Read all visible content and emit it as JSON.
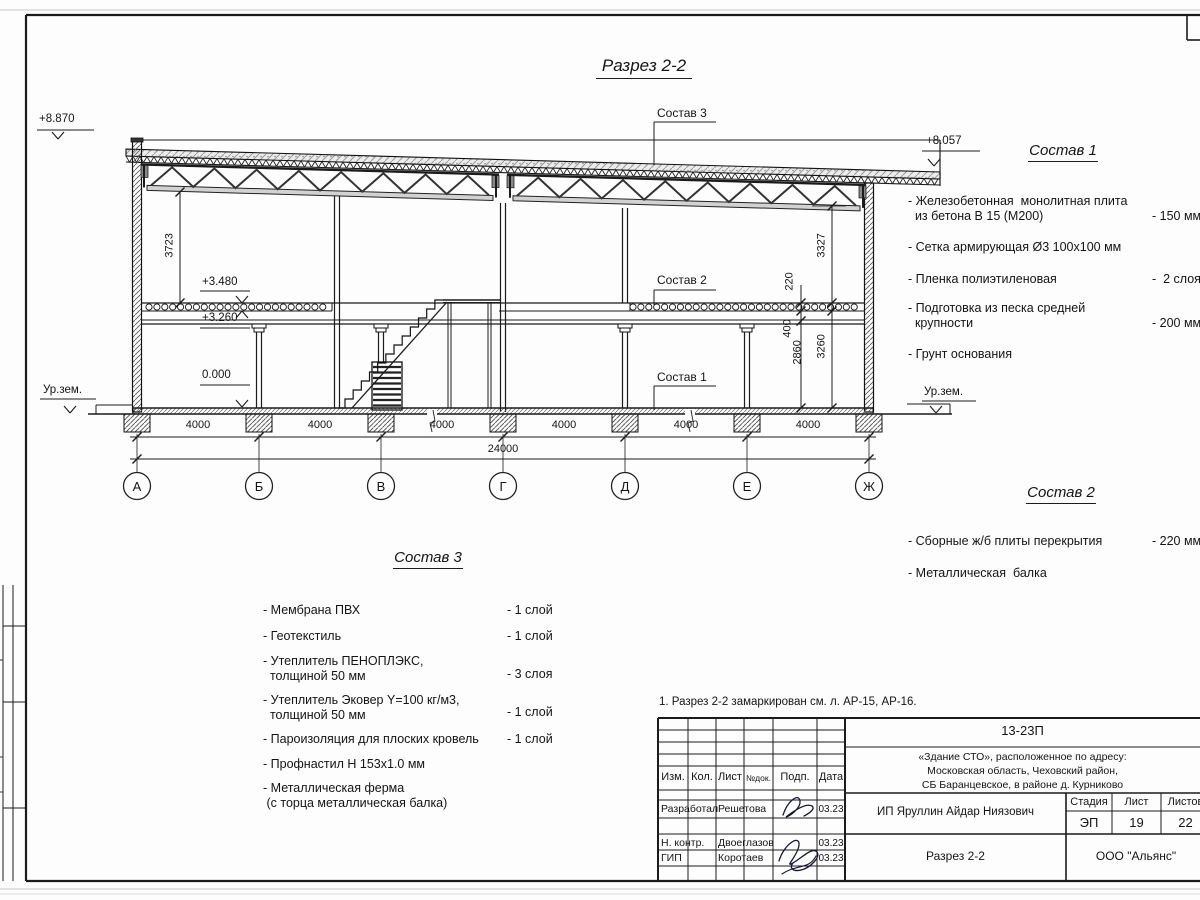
{
  "drawing": {
    "title": "Разрез 2-2",
    "note": "1. Разрез 2-2 замаркирован см. л. АР-15, АР-16."
  },
  "elevations": {
    "roof_left": "+8.870",
    "roof_right": "+8.057",
    "slab_top": "+3.480",
    "slab_bottom": "+3.260",
    "zero": "0.000",
    "ground_left": "Ур.зем.",
    "ground_right": "Ур.зем."
  },
  "dims": {
    "h_left": "3723",
    "h_right": "3327",
    "slab": "220",
    "beam": "400",
    "clear": "2860",
    "storey": "3260",
    "bays": [
      "4000",
      "4000",
      "4000",
      "4000",
      "4000",
      "4000"
    ],
    "total": "24000"
  },
  "axes": [
    "А",
    "Б",
    "В",
    "Г",
    "Д",
    "Е",
    "Ж"
  ],
  "callouts": {
    "c1": "Состав 1",
    "c2": "Состав 2",
    "c3": "Состав 3"
  },
  "sostav1": {
    "heading": "Состав 1",
    "items": [
      {
        "n": "- Железобетонная  монолитная плита\n  из бетона В 15 (М200)",
        "v": "- 150 мм"
      },
      {
        "n": "- Сетка армирующая Ø3 100х100 мм",
        "v": ""
      },
      {
        "n": "- Пленка полиэтиленовая",
        "v": "-  2 слоя"
      },
      {
        "n": "- Подготовка из песка средней\n  крупности",
        "v": "- 200 мм"
      },
      {
        "n": "- Грунт основания",
        "v": ""
      }
    ]
  },
  "sostav2": {
    "heading": "Состав 2",
    "items": [
      {
        "n": "- Сборные ж/б плиты перекрытия",
        "v": "- 220 мм"
      },
      {
        "n": "- Металлическая  балка",
        "v": ""
      }
    ]
  },
  "sostav3": {
    "heading": "Состав 3",
    "items": [
      {
        "n": "- Мембрана ПВХ",
        "v": "- 1 слой"
      },
      {
        "n": "- Геотекстиль",
        "v": "- 1 слой"
      },
      {
        "n": "- Утеплитель ПЕНОПЛЭКС,\n  толщиной 50 мм",
        "v": "- 3 слоя"
      },
      {
        "n": "- Утеплитель Эковер Y=100 кг/м3,\n  толщиной 50 мм",
        "v": "- 1 слой"
      },
      {
        "n": "- Пароизоляция для плоских кровель",
        "v": "- 1 слой"
      },
      {
        "n": "- Профнастил Н 153х1.0 мм",
        "v": ""
      },
      {
        "n": "- Металлическая ферма\n (с торца металлическая балка)",
        "v": ""
      }
    ]
  },
  "titleblock": {
    "doc": "13-23П",
    "project": "«Здание СТО», расположенное по адресу:\nМосковская область, Чеховский район,\nСБ Баранцевское, в районе д. Курниково",
    "cols": [
      "Изм.",
      "Кол.",
      "Лист",
      "№док.",
      "Подп.",
      "Дата"
    ],
    "rows": [
      {
        "role": "Разработал",
        "name": "Решетова",
        "date": "03.23"
      },
      {
        "role": "Н. контр.",
        "name": "Двоеглазов",
        "date": "03.23"
      },
      {
        "role": "ГИП",
        "name": "Коротаев",
        "date": "03.23"
      }
    ],
    "client": "ИП Яруллин Айдар Ниязович",
    "stage_label": "Стадия",
    "sheet_label": "Лист",
    "sheets_label": "Листов",
    "stage": "ЭП",
    "sheet": "19",
    "sheets": "22",
    "object": "Разрез 2-2",
    "company": "ООО \"Альянс\""
  }
}
